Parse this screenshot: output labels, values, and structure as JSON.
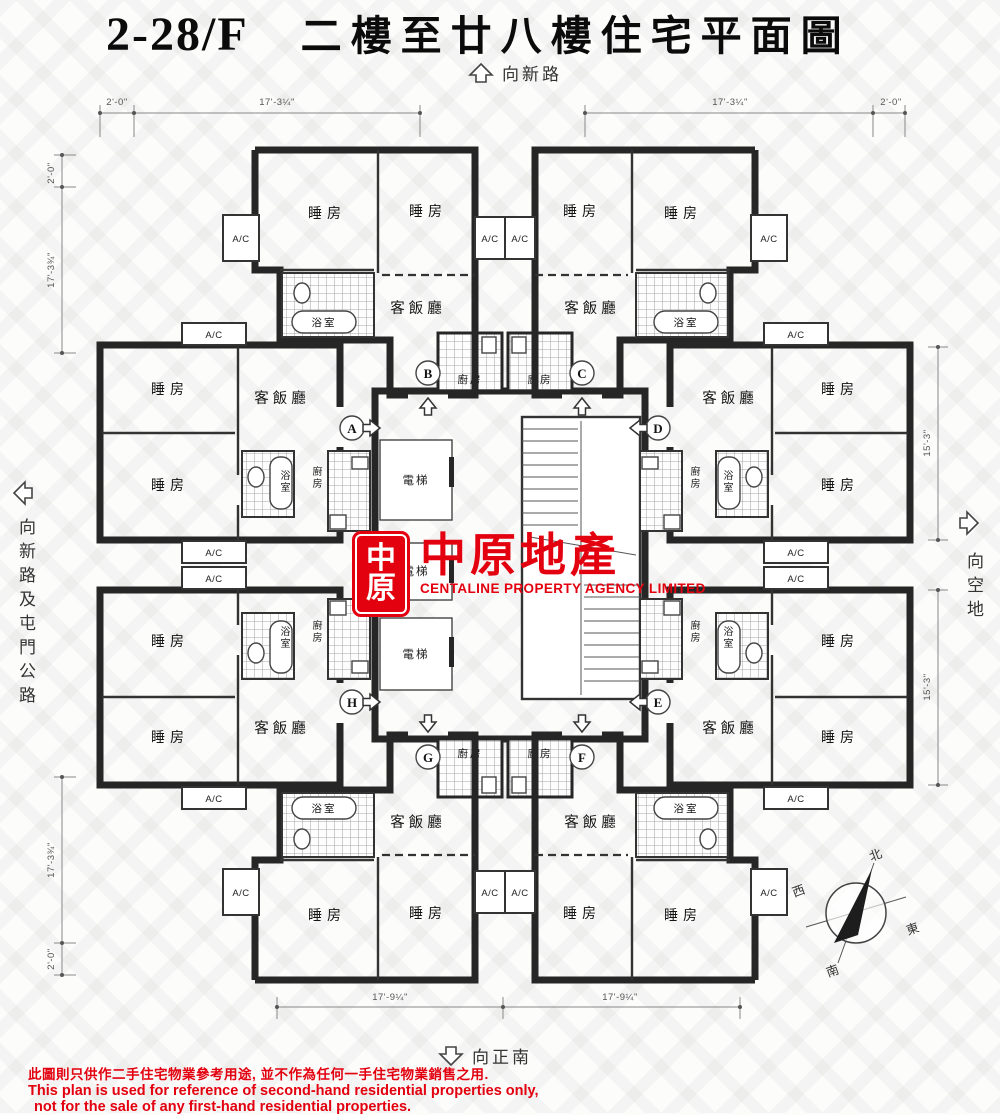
{
  "title": {
    "floor_range": "2-28/F",
    "name": "二樓至廿八樓住宅平面圖"
  },
  "orientation": {
    "top": "向新路",
    "bottom": "向正南",
    "left": "向新路及屯門公路",
    "right": "向空地"
  },
  "compass": {
    "north": "北",
    "south": "南",
    "east": "東",
    "west": "西"
  },
  "rooms": {
    "bedroom": "睡房",
    "living_dining": "客飯廳",
    "bathroom": "浴室",
    "kitchen": "廚房",
    "elevator": "電梯",
    "ac": "A/C"
  },
  "units": {
    "a": "A",
    "b": "B",
    "c": "C",
    "d": "D",
    "e": "E",
    "f": "F",
    "g": "G",
    "h": "H"
  },
  "dimensions": {
    "two_ft": "2'-0\"",
    "seventeen_3q": "17'-3¼\"",
    "seventeen_3t": "17'-3¾\"",
    "fifteen_3": "15'-3\"",
    "seventeen_9q": "17'-9¼\""
  },
  "logo": {
    "seal_char_top": "中",
    "seal_char_bottom": "原",
    "name_zh": "中原地產",
    "name_en": "CENTALINE PROPERTY AGENCY LIMITED",
    "brand_color": "#e3000f"
  },
  "disclaimer": {
    "zh": "此圖則只供作二手住宅物業參考用途, 並不作為任何一手住宅物業銷售之用.",
    "en1": "This plan is used for reference of second-hand residential properties only,",
    "en2": "not for the sale of any first-hand residential properties."
  }
}
